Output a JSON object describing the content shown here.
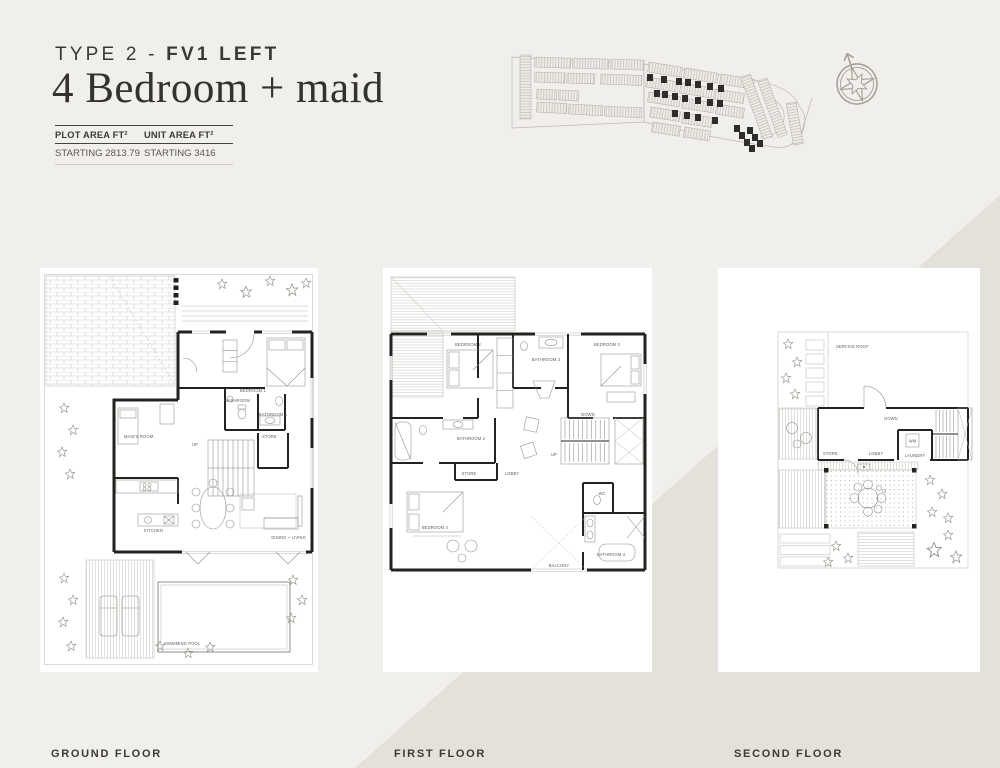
{
  "page": {
    "bg": "#f1efeb",
    "bg_diagonal": "#e4e0da",
    "text_dark": "#3b3936"
  },
  "header": {
    "type_prefix": "TYPE 2 - ",
    "type_bold": "FV1 LEFT",
    "title": "4 Bedroom + maid",
    "area_table": {
      "col1_header": "PLOT AREA FT²",
      "col2_header": "UNIT AREA FT²",
      "col1_value": "STARTING 2813.79",
      "col2_value": "STARTING 3416"
    }
  },
  "site_plan": {
    "description": "masterplan locator with highlighted units",
    "bar_fill": "#eeece7",
    "bar_stroke": "#b5b1a9",
    "highlight_color": "#2e2d2a",
    "bars": [
      {
        "x": 27,
        "y": 15,
        "w": 64,
        "h": 11,
        "a": 90
      },
      {
        "x": 31,
        "y": 17,
        "w": 36,
        "h": 10,
        "a": 2
      },
      {
        "x": 69,
        "y": 18,
        "w": 36,
        "h": 10,
        "a": 2
      },
      {
        "x": 107,
        "y": 19,
        "w": 33,
        "h": 10,
        "a": 2
      },
      {
        "x": 31,
        "y": 32,
        "w": 30,
        "h": 10,
        "a": 2
      },
      {
        "x": 63,
        "y": 33,
        "w": 28,
        "h": 10,
        "a": 2
      },
      {
        "x": 97,
        "y": 34,
        "w": 41,
        "h": 10,
        "a": 2
      },
      {
        "x": 33,
        "y": 49,
        "w": 20,
        "h": 10,
        "a": 3
      },
      {
        "x": 55,
        "y": 50,
        "w": 20,
        "h": 10,
        "a": 3
      },
      {
        "x": 33,
        "y": 62,
        "w": 30,
        "h": 10,
        "a": 3
      },
      {
        "x": 65,
        "y": 64,
        "w": 34,
        "h": 10,
        "a": 3
      },
      {
        "x": 101,
        "y": 66,
        "w": 37,
        "h": 10,
        "a": 3
      },
      {
        "x": 145,
        "y": 22,
        "w": 34,
        "h": 10,
        "a": 9
      },
      {
        "x": 181,
        "y": 28,
        "w": 34,
        "h": 10,
        "a": 9
      },
      {
        "x": 217,
        "y": 34,
        "w": 34,
        "h": 10,
        "a": 9
      },
      {
        "x": 143,
        "y": 37,
        "w": 32,
        "h": 10,
        "a": 9
      },
      {
        "x": 177,
        "y": 43,
        "w": 32,
        "h": 10,
        "a": 9
      },
      {
        "x": 211,
        "y": 49,
        "w": 30,
        "h": 10,
        "a": 9
      },
      {
        "x": 145,
        "y": 52,
        "w": 32,
        "h": 10,
        "a": 9
      },
      {
        "x": 179,
        "y": 58,
        "w": 32,
        "h": 10,
        "a": 9
      },
      {
        "x": 213,
        "y": 64,
        "w": 28,
        "h": 10,
        "a": 9
      },
      {
        "x": 147,
        "y": 67,
        "w": 30,
        "h": 10,
        "a": 9
      },
      {
        "x": 179,
        "y": 73,
        "w": 30,
        "h": 10,
        "a": 9
      },
      {
        "x": 149,
        "y": 82,
        "w": 28,
        "h": 10,
        "a": 9
      },
      {
        "x": 181,
        "y": 87,
        "w": 26,
        "h": 10,
        "a": 9
      },
      {
        "x": 246,
        "y": 34,
        "w": 66,
        "h": 10,
        "a": 70
      },
      {
        "x": 263,
        "y": 38,
        "w": 60,
        "h": 10,
        "a": 70
      },
      {
        "x": 292,
        "y": 62,
        "w": 42,
        "h": 10,
        "a": 80
      }
    ],
    "dark_units": [
      [
        143,
        34
      ],
      [
        157,
        36
      ],
      [
        172,
        38
      ],
      [
        181,
        39
      ],
      [
        191,
        41
      ],
      [
        203,
        43
      ],
      [
        214,
        45
      ],
      [
        150,
        50
      ],
      [
        158,
        51
      ],
      [
        168,
        53
      ],
      [
        178,
        55
      ],
      [
        191,
        57
      ],
      [
        203,
        59
      ],
      [
        213,
        60
      ],
      [
        168,
        70
      ],
      [
        180,
        72
      ],
      [
        191,
        74
      ],
      [
        208,
        77
      ],
      [
        230,
        85
      ],
      [
        235,
        92
      ],
      [
        240,
        99
      ],
      [
        245,
        105
      ],
      [
        243,
        87
      ],
      [
        248,
        94
      ],
      [
        253,
        100
      ]
    ],
    "outlines": [
      "M8,17 L140,24 L140,82 L8,88 Z",
      "M140,24 L250,40 C272,44 288,52 293,62 L300,74 C304,92 292,106 276,108 L250,104 C214,98 180,92 140,82 Z",
      "M262,56 C274,60 281,68 280,78 C279,90 268,98 256,97",
      "M246,34 L268,98",
      "M308,58 L294,104"
    ]
  },
  "compass": {
    "icon": "compass-rose"
  },
  "floors": [
    {
      "label": "GROUND FLOOR",
      "rooms": {
        "bedroom1": "BEDROOM 1",
        "washroom": "WASHROOM",
        "bathroom1": "BATHROOM 1",
        "store": "STORE",
        "up": "UP",
        "maids_room": "MAID'S ROOM",
        "kitchen": "KITCHEN",
        "dining_living": "DINING + LIVING",
        "swimming_pool": "SWIMMING POOL"
      }
    },
    {
      "label": "FIRST FLOOR",
      "rooms": {
        "bedroom2": "BEDROOM 2",
        "bathroom3": "BATHROOM 3",
        "bedroom3": "BEDROOM 3",
        "bathroom2": "BATHROOM 2",
        "store": "STORE",
        "lobby": "LOBBY",
        "down": "DOWN",
        "up": "UP",
        "bedroom4": "BEDROOM 4",
        "wc": "WC",
        "bathroom4": "BATHROOM 4",
        "balcony": "BALCONY"
      }
    },
    {
      "label": "SECOND FLOOR",
      "rooms": {
        "service_roof": "SERVICE ROOF",
        "down": "DOWN",
        "store": "STORE",
        "lobby": "LOBBY",
        "laundry": "LAUNDRY",
        "wm": "WM"
      }
    }
  ]
}
